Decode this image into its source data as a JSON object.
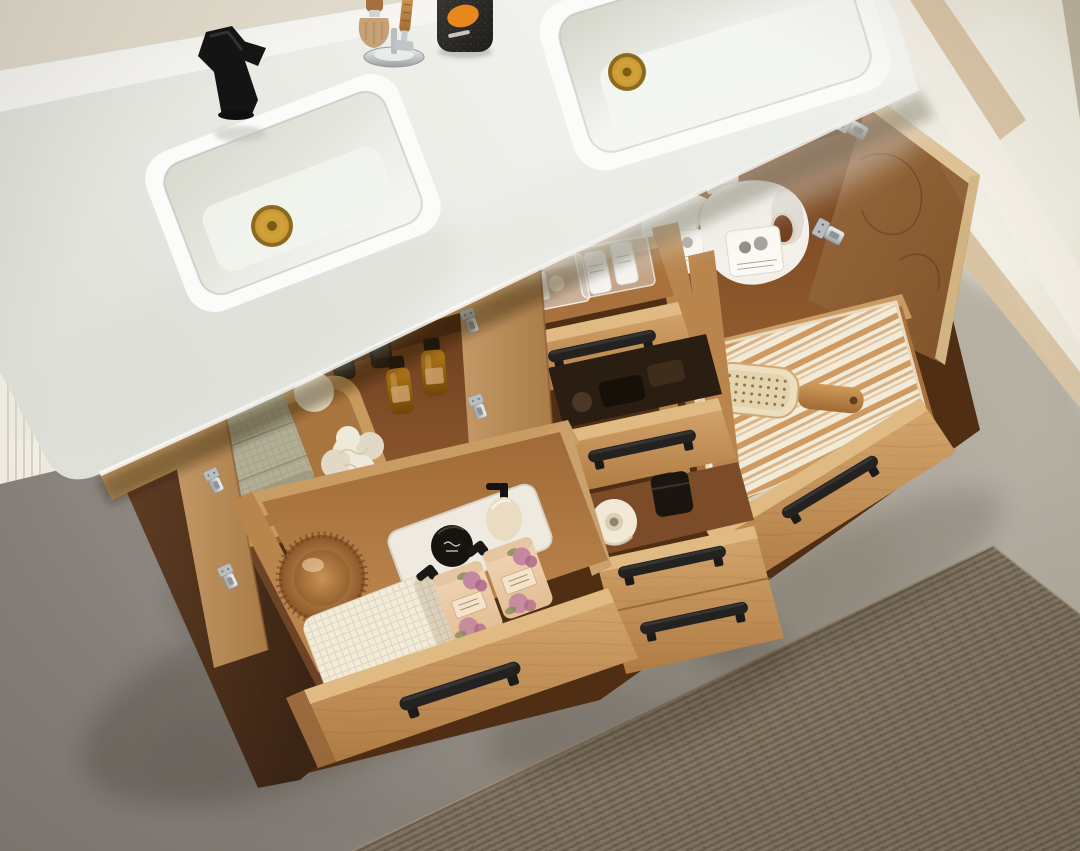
{
  "scene": {
    "type": "product-photograph",
    "room": "bathroom",
    "subject": "Overhead view of a light oak double-sink bathroom vanity with a white quartz top, two open cabinet doors and five open drawers showing organized bath storage",
    "open_doors": 2,
    "open_drawers": 5
  },
  "labels": {
    "photo": "bathroom vanity product photo",
    "wall": "beige wall with white baseboard",
    "curtain": "white pleated curtain",
    "window": "bright glass doorway with light wood trim",
    "floor": "gray concrete floor",
    "rug": "woven taupe area rug",
    "vanity": "light oak double vanity cabinet",
    "countertop": "white quartz countertop",
    "backsplash": "white quartz backsplash",
    "sink_left": "left rectangular undermount sink",
    "sink_right": "right rectangular undermount sink",
    "drain_left": "brushed gold pop-up drain",
    "drain_right": "brushed gold pop-up drain",
    "faucet": "matte black single-handle faucet",
    "shaving_kit": "chrome shaving stand with badger brush and razor",
    "canister": "black textured canister with orange oval label",
    "left_cabinet": "open left cabinet: wooden tray with sage waffle towel, bath pouf, cream soap dispenser, two black and two amber apothecary bottles",
    "left_cabinet_door": "open left cabinet door with nickel hinges",
    "left_drawer": "large open drawer: round wooden body brush, cream waffle towel, ceramic tray with black jar and lotion pump, two pink floral soap bottles",
    "middle_drawer_top": "open drawer with clear acrylic organizers of toothbrushes, swabs and two white travel bottles",
    "middle_drawer_mid": "open drawer with dark grooming accessories",
    "middle_drawer_bottom": "open drawer with spare toilet-paper roll and black jar",
    "right_cabinet": "open right cabinet with two white laundry detergent jugs",
    "right_cabinet_door": "open right cabinet door with nickel concealed hinges",
    "right_drawer": "wide open drawer with tan striped cotton towel and wooden paddle hair brush",
    "handle": "matte black bar pull",
    "hinge": "nickel concealed hinge"
  },
  "palette": {
    "wallTop": "#e3ddce",
    "wallBottom": "#d2c3b2",
    "baseboard": "#efeadf",
    "curtain": "#f4f0e6",
    "curtainShade": "#d9d3c5",
    "floorDark": "#87827b",
    "floorLight": "#b7b1a5",
    "floorMottle": "#8a8060",
    "windowBright": "#ede9dc",
    "windowJamb": "#f4f0e7",
    "windowTrim": "#d8c3a3",
    "windowEdge": "#b3a68e",
    "rugBase": "#877a66",
    "rugLight": "#9e9078",
    "rugDark": "#6e6252",
    "counterTop": "#f7f7f4",
    "counterMid": "#ecede7",
    "counterLow": "#dfe0d9",
    "backsplash": "#f6f5f1",
    "counterEdgeHi": "#fbfbf9",
    "sinkRim": "#fbfbf9",
    "basinSage": "#d6d9cd",
    "basinWhite": "#f5f6f2",
    "goldDark": "#8a6a1e",
    "gold": "#c9972f",
    "goldLight": "#e2b65a",
    "faucetBlack": "#141414",
    "faucetHi": "#3a3a3a",
    "chromeHi": "#f1f2f2",
    "chromeLo": "#9aa0a2",
    "bristle": "#c6a178",
    "woodHandle": "#a8713d",
    "canisterHi": "#3a3835",
    "canisterDark": "#1e1d1b",
    "labelOrange": "#e7871c",
    "oakHi": "#d5a76e",
    "oakLo": "#b07c44",
    "oakLight": "#dfbb83",
    "oakGrain": "#a97a42",
    "doorEdgeHi": "#c59a66",
    "doorEdgeLo": "#a87a46",
    "doorInnerHi": "#9a6a3e",
    "doorInnerLo": "#7f5229",
    "doorBand": "#ddc092",
    "interiorHi": "#9a6236",
    "interiorLo": "#6b3d1c",
    "interior2Hi": "#915c2e",
    "interior2Lo": "#713f1b",
    "interiorDark": "#4f2e13",
    "walnutHi": "#6a4428",
    "walnutLo": "#3b2414",
    "drawerFloorHi": "#c08a50",
    "drawerFloorLo": "#a06a38",
    "wallStrip": "#c99c64",
    "wallStripDark": "#b9854d",
    "trayWood": "#c89a5e",
    "trayWoodIn": "#a9763f",
    "sage": "#b2af96",
    "sageDark": "#8f8c74",
    "cream": "#f2ebd8",
    "creamShade": "#e4dac2",
    "loofah": "#efe9d9",
    "loofahShade": "#e2d9c4",
    "creamBottle": "#e9dcc2",
    "amberHi": "#b5791b",
    "amberLo": "#6e4607",
    "darkBottle": "#241e17",
    "jugWhite": "#f3f0e9",
    "jugShade": "#d8d2c4",
    "jugLabel": "#fbf9f4",
    "pinkHi": "#f0d6b6",
    "pinkLo": "#e3bd94",
    "rose": "#c387a0",
    "roseDark": "#a96384",
    "leaf": "#7d8a5a",
    "pinkLabel": "#f4e3cb",
    "trayWhite": "#efeadf",
    "jarBlack": "#17130e",
    "paper": "#f1e9d6",
    "paperIn": "#dbcdb6",
    "paperCore": "#93836a",
    "stripeTan": "#cf9a62",
    "handleBlack": "#232221",
    "handleHi": "#4a4846",
    "nickel": "#b9bdc0",
    "nickelDark": "#8a8e91"
  }
}
